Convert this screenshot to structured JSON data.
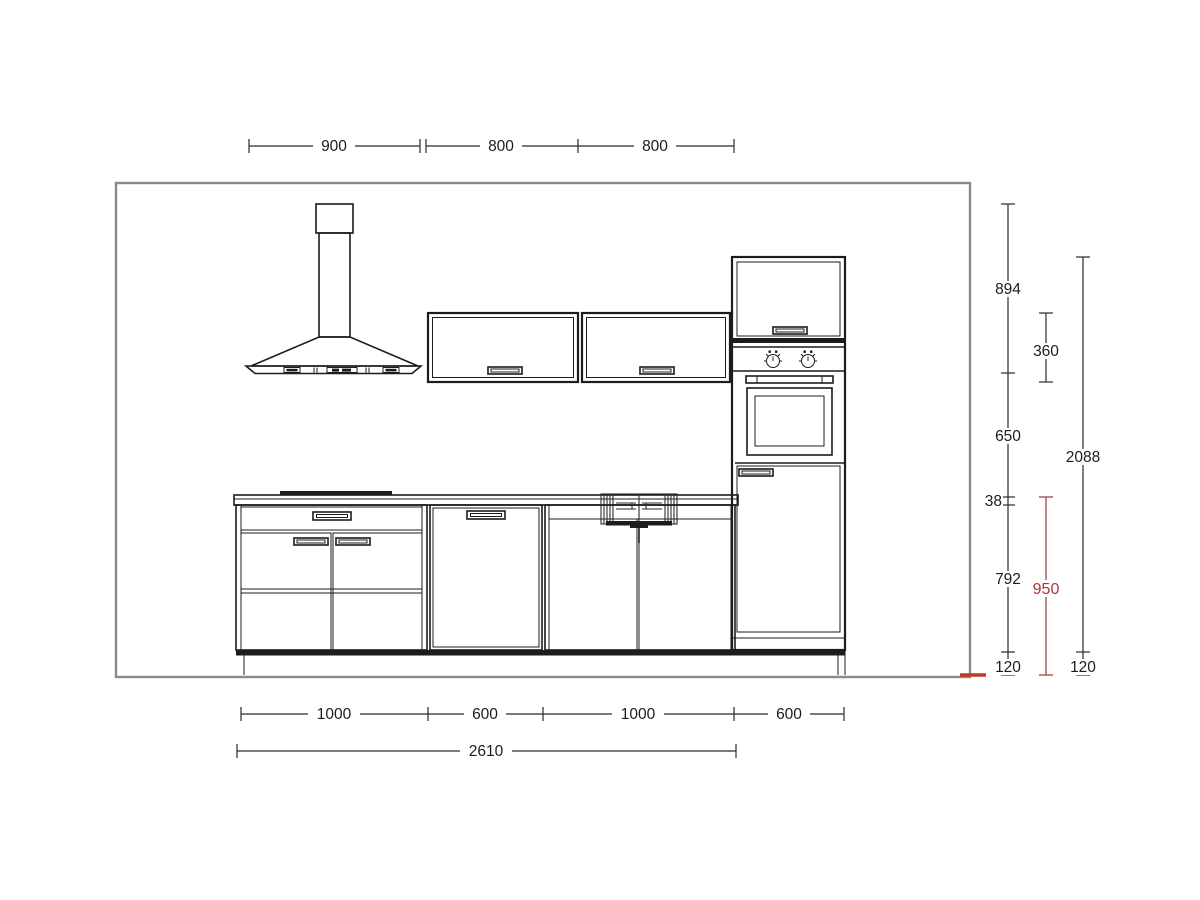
{
  "drawing": {
    "kind": "kitchen elevation technical drawing",
    "colors": {
      "line": "#1c1c1c",
      "wall_outline": "#8a8a8a",
      "red_accent": "#b23535",
      "background": "#ffffff"
    },
    "components": [
      "chimney-extractor-hood",
      "wall-cabinet-left",
      "wall-cabinet-right",
      "tall-oven-housing",
      "base-drawer-unit",
      "dishwasher-unit",
      "sink-base-unit",
      "worktop",
      "hob",
      "plinth"
    ],
    "dimensions": {
      "top": [
        "900",
        "800",
        "800"
      ],
      "right": {
        "hood_height": "894",
        "wall_unit_height": "360",
        "hood_to_worktop": "650",
        "tall_unit_height": "2088",
        "worktop_thickness": "38",
        "base_unit_height": "792",
        "worktop_level": "950",
        "plinth_left": "120",
        "plinth_right": "120"
      },
      "bottom": [
        "1000",
        "600",
        "1000",
        "600"
      ],
      "bottom_total": "2610"
    }
  }
}
